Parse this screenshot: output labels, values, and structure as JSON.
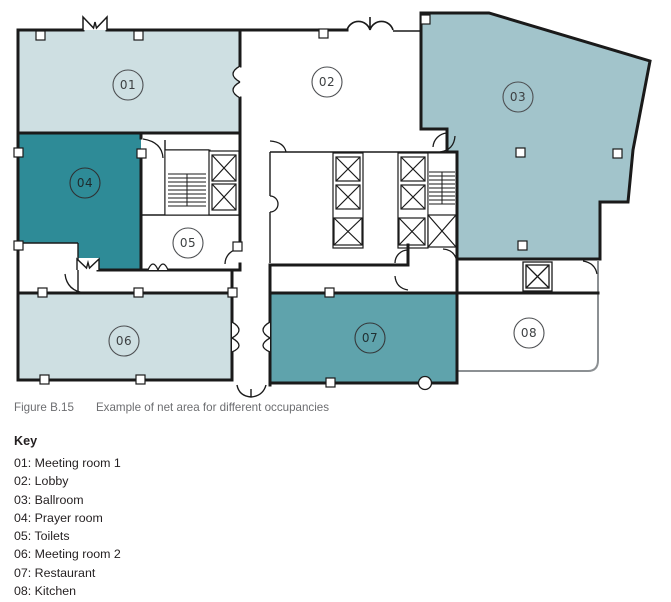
{
  "figure": {
    "caption_label": "Figure B.15",
    "caption_text": "Example of net area for different occupancies"
  },
  "key": {
    "title": "Key",
    "items": [
      "01: Meeting room 1",
      "02: Lobby",
      "03: Ballroom",
      "04: Prayer room",
      "05: Toilets",
      "06: Meeting room 2",
      "07: Restaurant",
      "08: Kitchen"
    ]
  },
  "plan": {
    "rooms": [
      {
        "id": "01",
        "label": "01",
        "name": "Meeting room 1",
        "fill": "#cedfe2"
      },
      {
        "id": "02",
        "label": "02",
        "name": "Lobby",
        "fill": "#ffffff"
      },
      {
        "id": "03",
        "label": "03",
        "name": "Ballroom",
        "fill": "#a2c4cb"
      },
      {
        "id": "04",
        "label": "04",
        "name": "Prayer room",
        "fill": "#2e8b97"
      },
      {
        "id": "05",
        "label": "05",
        "name": "Toilets",
        "fill": "#ffffff"
      },
      {
        "id": "06",
        "label": "06",
        "name": "Meeting room 2",
        "fill": "#cedfe2"
      },
      {
        "id": "07",
        "label": "07",
        "name": "Restaurant",
        "fill": "#5fa3ac"
      },
      {
        "id": "08",
        "label": "08",
        "name": "Kitchen",
        "fill": "#ffffff"
      }
    ]
  },
  "palette": {
    "wall": "#1a1a1a",
    "light_wall": "#8c9093",
    "room_light": "#cedfe2",
    "room_medium": "#a2c4cb",
    "room_dark": "#2e8b97",
    "room_teal": "#5fa3ac",
    "caption_text": "#6d6e71",
    "body_text": "#231f20"
  }
}
